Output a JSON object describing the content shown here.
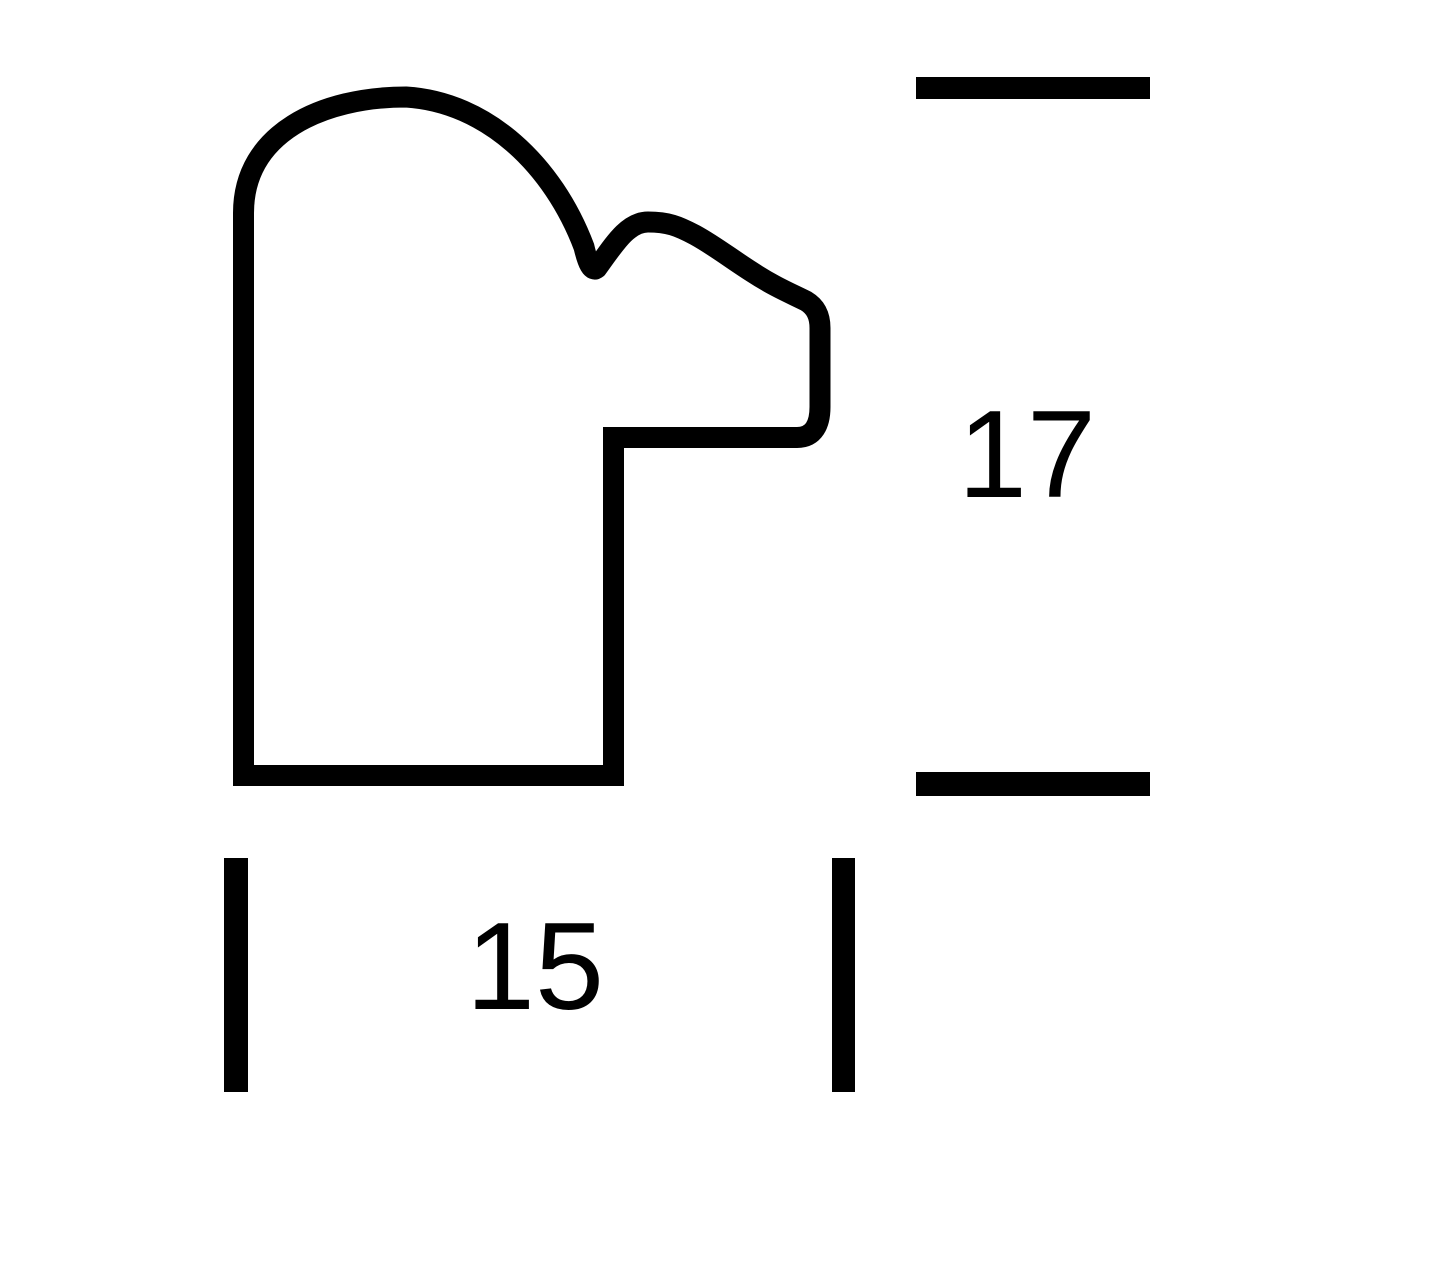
{
  "diagram": {
    "background_color": "#ffffff",
    "line_color": "#000000",
    "height_dimension": {
      "value": "17"
    },
    "width_dimension": {
      "value": "15"
    }
  }
}
